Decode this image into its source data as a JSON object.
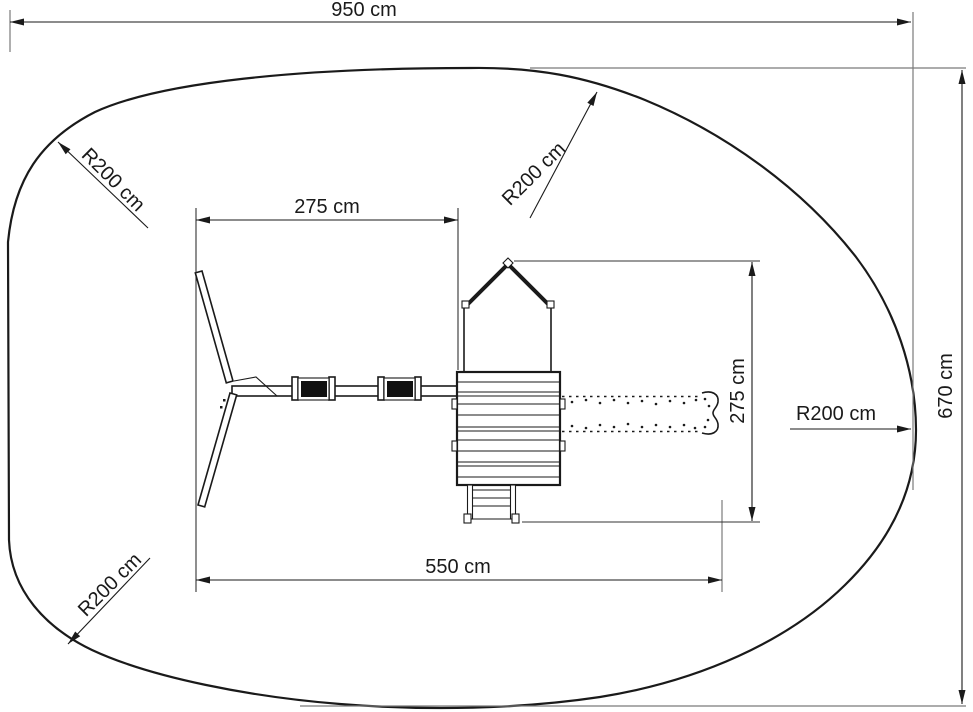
{
  "labels": {
    "overall_width": "950 cm",
    "overall_depth": "670 cm",
    "swing_section_width": "275 cm",
    "structure_length": "550 cm",
    "tower_slide_depth": "275 cm",
    "radius_top_left": "R200 cm",
    "radius_top_right": "R200 cm",
    "radius_right": "R200 cm",
    "radius_bottom_left": "R200 cm"
  },
  "colors": {
    "line": "#1a1a1a",
    "extension": "#7a7a7a",
    "background": "#ffffff"
  }
}
